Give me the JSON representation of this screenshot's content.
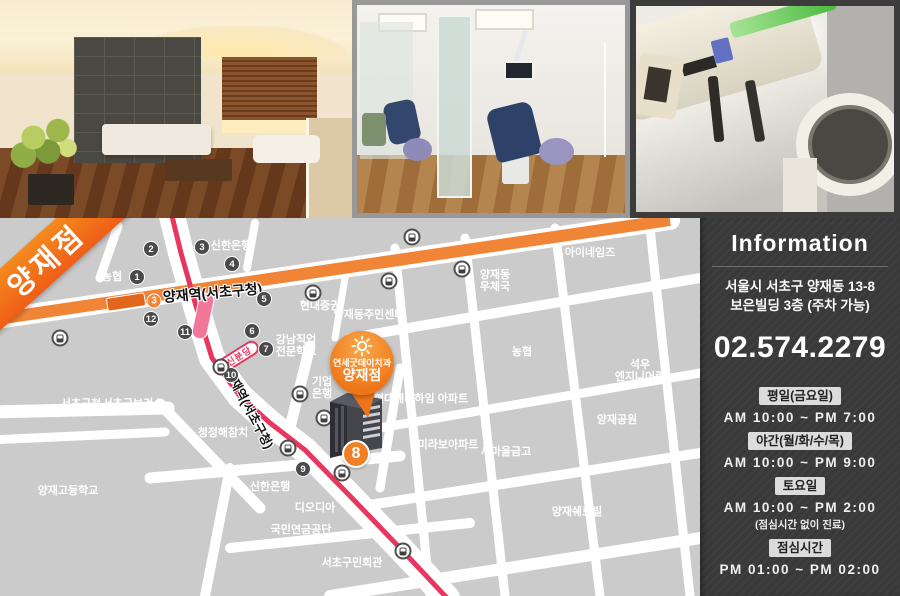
{
  "colors": {
    "line3_orange": "#f08437",
    "shinbundang_red": "#e8365f",
    "marker_orange": "#ee7518",
    "panel_bg": "#393939",
    "map_block_gray": "#cbcbcb"
  },
  "map": {
    "ribbon_label": "양재점",
    "line3_badge": "3",
    "line3_station_label": "양재역(서초구청)",
    "rotated_station_label": "양재역(서초구청)",
    "shinbundang_label": "신분당",
    "exit8_label": "8",
    "exits": [
      "1",
      "2",
      "3",
      "4",
      "5",
      "6",
      "7",
      "9",
      "10",
      "11",
      "12"
    ],
    "marker": {
      "line1": "연세굿데이치과",
      "line2": "양재점"
    },
    "labels": [
      {
        "text": "농협"
      },
      {
        "text": "신한은행"
      },
      {
        "text": "현대증권"
      },
      {
        "text": "양재동주민센터"
      },
      {
        "text": "강남직업\n전문학교"
      },
      {
        "text": "기업\n은행"
      },
      {
        "text": "현대테라하임 아파트"
      },
      {
        "text": "미라보아파트"
      },
      {
        "text": "새마을금고"
      },
      {
        "text": "양재공원"
      },
      {
        "text": "양재쉐르빌"
      },
      {
        "text": "석우\n엔지니어링"
      },
      {
        "text": "농협"
      },
      {
        "text": "양재동\n우체국"
      },
      {
        "text": "아이네임즈"
      },
      {
        "text": "서초구청"
      },
      {
        "text": "서초구보건소"
      },
      {
        "text": "청정해참치"
      },
      {
        "text": "양재고등학교"
      },
      {
        "text": "신한은행"
      },
      {
        "text": "디오디아"
      },
      {
        "text": "국민연금공단"
      },
      {
        "text": "서초구민회관"
      }
    ]
  },
  "info": {
    "title": "Information",
    "address_line1": "서울시 서초구 양재동 13-8",
    "address_line2": "보은빌딩  3층 (주차 가능)",
    "phone": "02.574.2279",
    "hours": [
      {
        "badge": "평일(금요일)",
        "time": "AM 10:00 ~ PM 7:00"
      },
      {
        "badge": "야간(월/화/수/목)",
        "time": "AM 10:00 ~ PM 9:00"
      },
      {
        "badge": "토요일",
        "time": "AM 10:00 ~ PM 2:00",
        "note": "(점심시간 없이 진료)"
      },
      {
        "badge": "점심시간",
        "time": "PM 01:00 ~ PM 02:00"
      }
    ]
  }
}
